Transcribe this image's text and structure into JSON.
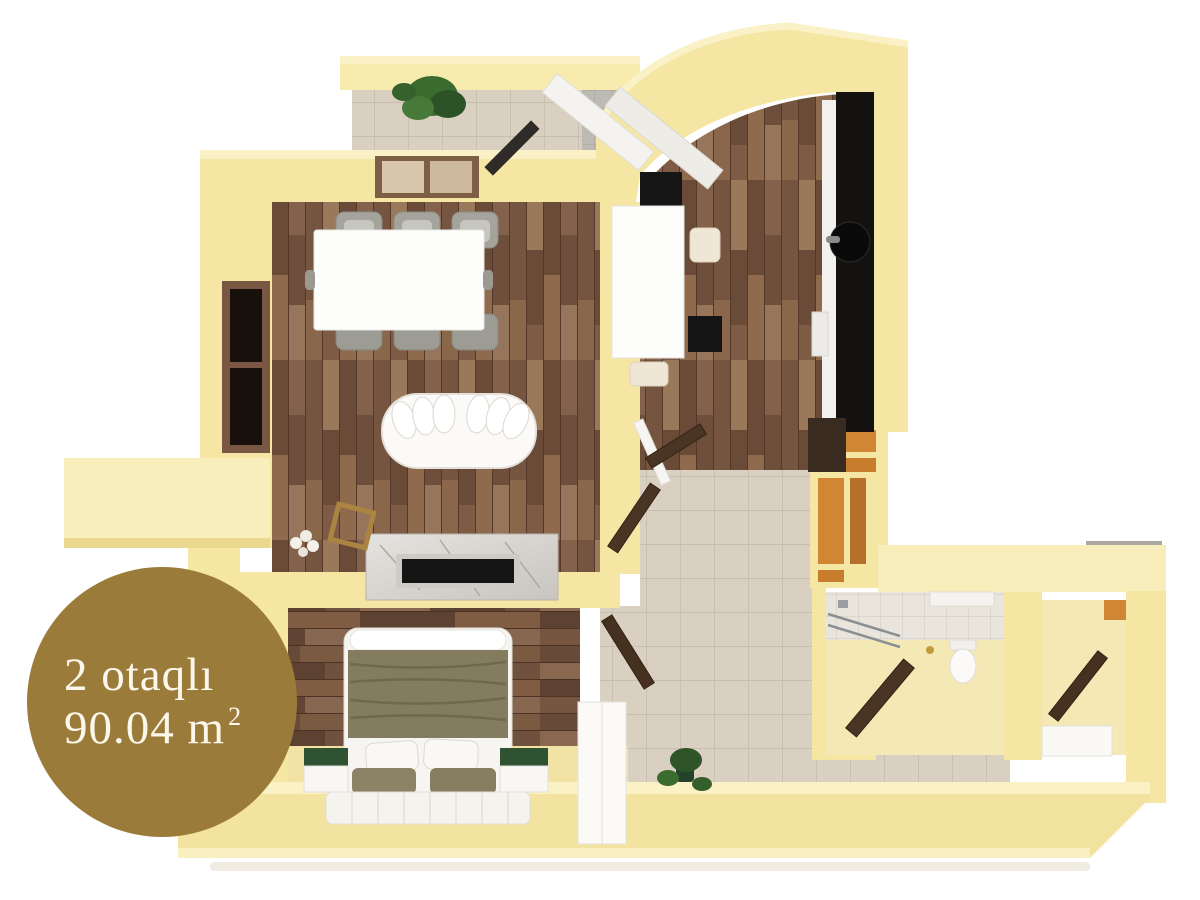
{
  "badge": {
    "line1": "2 otaqlı",
    "line2_base": "90.04 m",
    "line2_sup": "2",
    "bg_color": "#9B7B3A",
    "text_color": "#FCF7EB"
  },
  "palette": {
    "wall": "#F5E6A4",
    "wall_light": "#FAF2C6",
    "wall_shade": "#E7D189",
    "niche_orange": "#D08632",
    "wood_mid": "#7C5A43",
    "tile_beige": "#D9D0C1",
    "bath_tile": "#E9E5DD",
    "counter_black": "#141210",
    "door_brown": "#4A3423",
    "blanket_olive": "#837C5F",
    "nightstand_green": "#2F5233",
    "plant_green": "#3A6B2F",
    "marble": "#D9D6D1"
  }
}
